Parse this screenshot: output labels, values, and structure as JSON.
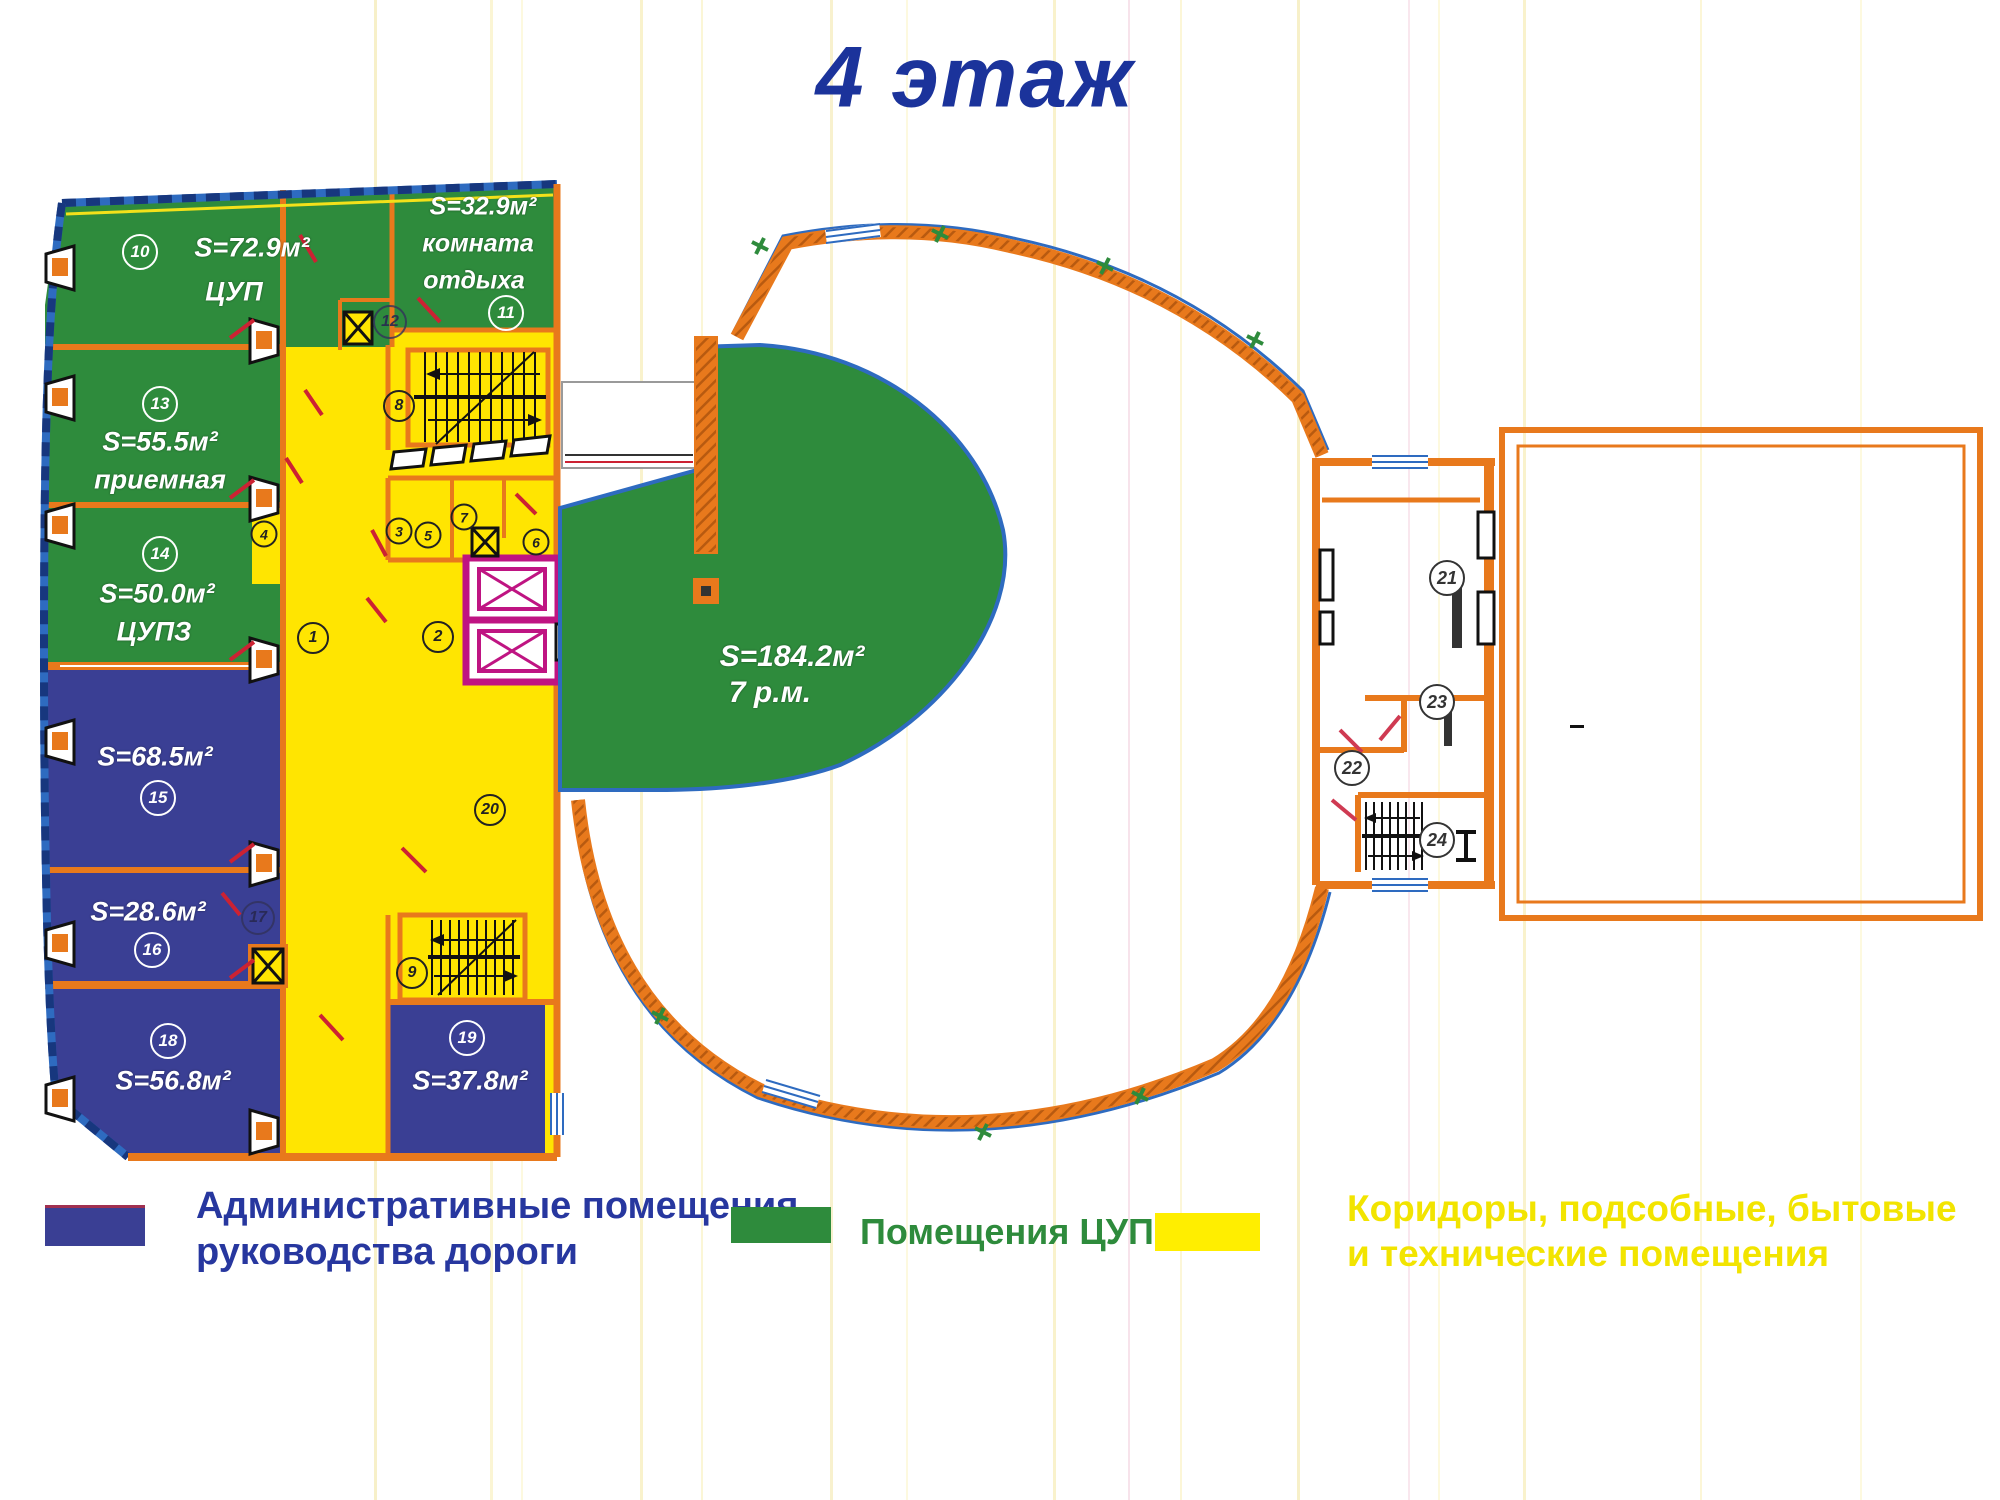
{
  "title": "4 этаж",
  "rooms": {
    "r10": {
      "num": "10",
      "area": "S=72.9м²",
      "name": "ЦУП"
    },
    "r11": {
      "num": "11",
      "area": "S=32.9м²",
      "name1": "комната",
      "name2": "отдыха"
    },
    "r13": {
      "num": "13",
      "area": "S=55.5м²",
      "name": "приемная"
    },
    "r14": {
      "num": "14",
      "area": "S=50.0м²",
      "name": "ЦУПЗ"
    },
    "r15": {
      "num": "15",
      "area": "S=68.5м²"
    },
    "r16": {
      "num": "16",
      "area": "S=28.6м²"
    },
    "r18": {
      "num": "18",
      "area": "S=56.8м²"
    },
    "r19": {
      "num": "19",
      "area": "S=37.8м²"
    },
    "hall": {
      "area": "S=184.2м²",
      "name": "7 р.м."
    }
  },
  "circles": {
    "n1": "1",
    "n2": "2",
    "n3": "3",
    "n4": "4",
    "n5": "5",
    "n6": "6",
    "n7": "7",
    "n8": "8",
    "n9": "9",
    "n12": "12",
    "n17": "17",
    "n20": "20",
    "n21": "21",
    "n22": "22",
    "n23": "23",
    "n24": "24"
  },
  "legend": {
    "admin": {
      "line1": "Административные помещения",
      "line2": "руководства дороги",
      "color": "#3a3f94"
    },
    "cup": {
      "line1": "Помещения ЦУП",
      "color": "#2e8b3c"
    },
    "corridor": {
      "line1": "Коридоры, подсобные, бытовые",
      "line2": "и технические помещения",
      "color": "#f2e400"
    }
  },
  "colors": {
    "admin_rooms": "#3a3f94",
    "cup_rooms": "#2e8b3c",
    "corridors": "#ffe501",
    "walls": "#e8791c",
    "window_border": "#2e6bc0",
    "elevator": "#bf1482",
    "title_text": "#1b339b",
    "door_marks": "#cc2233"
  }
}
